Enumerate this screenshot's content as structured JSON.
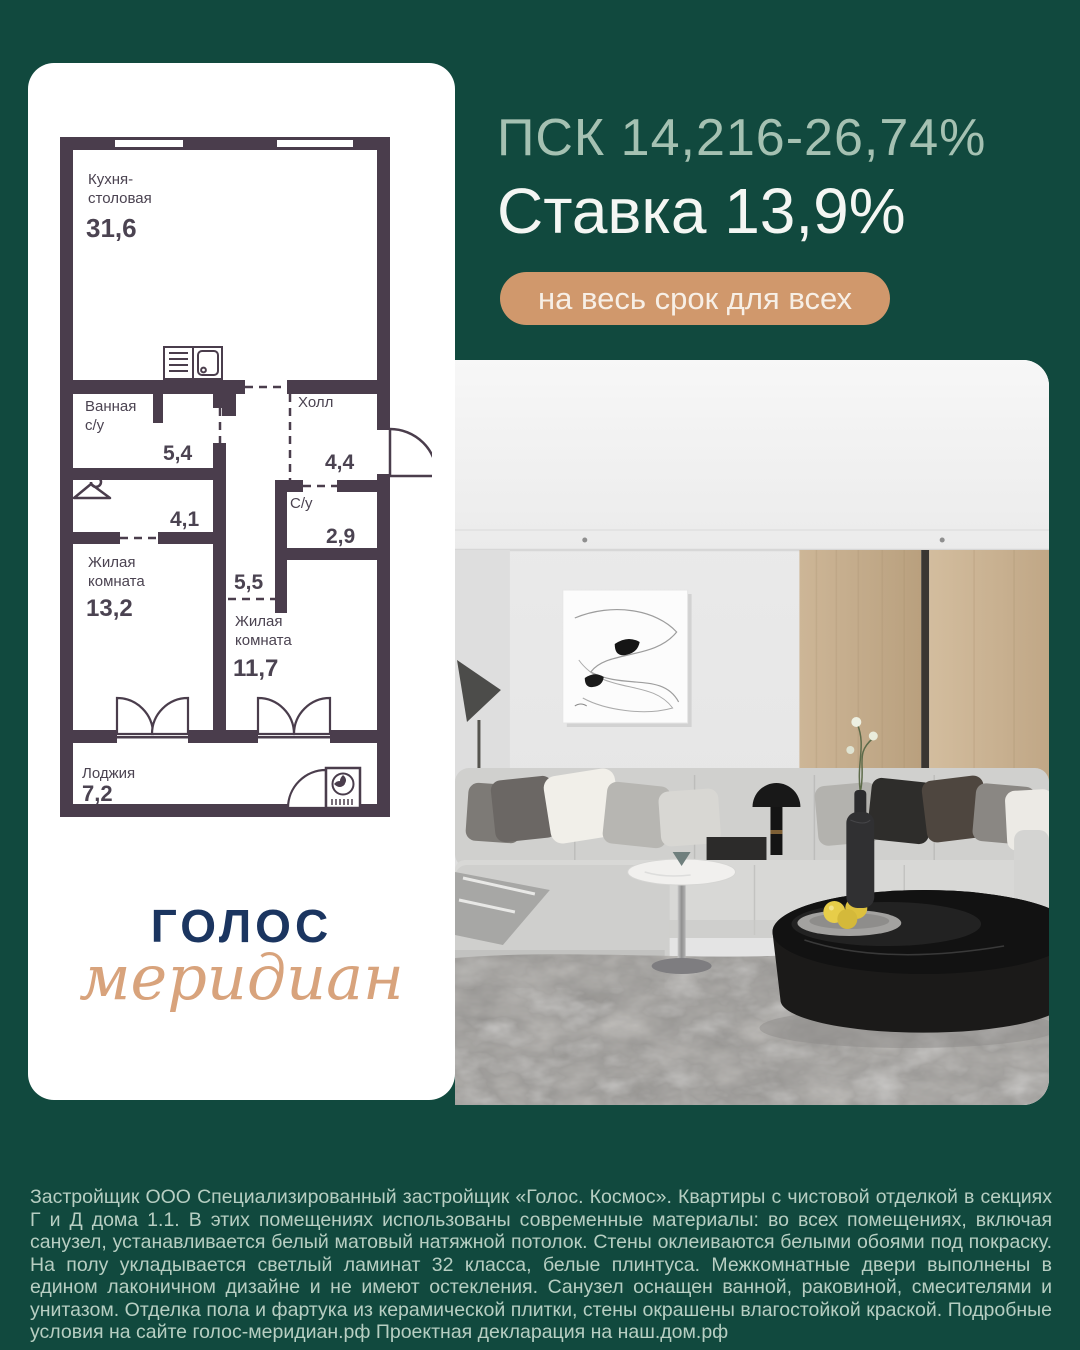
{
  "colors": {
    "background": "#11493E",
    "card": "#FFFFFF",
    "psk_text": "#A5C1B2",
    "rate_text": "#F4F6F3",
    "badge_bg": "#D0986C",
    "badge_text": "#F7EFE6",
    "plan_walls": "#4A3D4C",
    "plan_text": "#4B4351",
    "logo_navy": "#1B3560",
    "logo_tan": "#D8A37C",
    "disclaimer_text": "#B7CEC2"
  },
  "offer": {
    "psk_line": "ПСК 14,216-26,74%",
    "rate_line": "Ставка 13,9%",
    "badge": "на весь срок для всех"
  },
  "floorplan": {
    "rooms": {
      "kitchen": {
        "label1": "Кухня-",
        "label2": "столовая",
        "area": "31,6"
      },
      "bath": {
        "label1": "Ванная",
        "label2": "с/у",
        "area": "5,4"
      },
      "hall": {
        "label": "Холл",
        "area": "4,4"
      },
      "wardrobe": {
        "area": "4,1"
      },
      "living1": {
        "label1": "Жилая",
        "label2": "комната",
        "area": "13,2"
      },
      "su": {
        "label": "С/у",
        "area": "2,9"
      },
      "corridor": {
        "area": "5,5"
      },
      "living2": {
        "label1": "Жилая",
        "label2": "комната",
        "area": "11,7"
      },
      "loggia": {
        "label": "Лоджия",
        "area": "7,2"
      }
    }
  },
  "logo": {
    "line1": "ГОЛОС",
    "line2": "меридиан"
  },
  "disclaimer": "Застройщик ООО Специализированный застройщик «Голос. Космос». Квартиры с чистовой отделкой в секциях Г и Д дома 1.1. В этих помещениях использованы современные материалы: во всех помещениях, включая санузел, устанавливается белый матовый натяжной потолок. Стены оклеиваются белыми обоями под покраску. На полу укладывается светлый ламинат 32 класса, белые плинтуса. Межкомнатные двери выполнены в едином лаконичном дизайне и не имеют остекления. Санузел оснащен ванной, раковиной, смесителями и унитазом. Отделка пола и фартука из керамической плитки, стены окрашены влагостойкой краской. Подробные условия на сайте голос-меридиан.рф Проектная декларация на наш.дом.рф"
}
